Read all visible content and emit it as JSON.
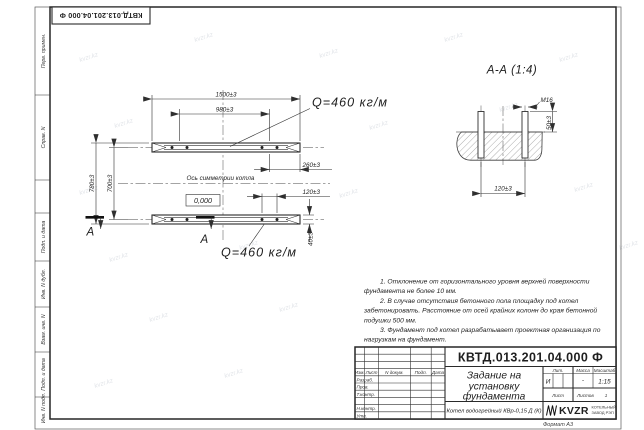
{
  "sheet": {
    "doc_number_top": "КВТД.013.201.04.000 Ф",
    "format_note": "Формат А3",
    "watermark": "kvzr.kz",
    "margin_labels": {
      "perv": "Перв. примен.",
      "sprav": "Справ. N",
      "podp1": "Подп. и дата",
      "inv_dubl": "Инв. N дубл.",
      "vzam": "Взам. инв. N",
      "podp2": "Подп. и дата",
      "inv_podl": "Инв. N подл."
    }
  },
  "plan": {
    "dim_1500": "1500±3",
    "dim_980": "980±3",
    "dim_780": "780±3",
    "dim_700": "700±3",
    "dim_260": "260±3",
    "dim_120": "120±3",
    "dim_40": "40±3",
    "level": "0,000",
    "axis_label": "Ось симметрии котла",
    "load_top": "Q=460 кг/м",
    "load_bottom": "Q=460 кг/м",
    "section_letter_left": "А",
    "section_letter_right": "А"
  },
  "section": {
    "title": "А-А (1:4)",
    "thread": "М16",
    "dim_50": "50±3",
    "dim_120": "120±3"
  },
  "notes": {
    "l1": "1. Отклонение от горизонтального уровня верхней поверхности",
    "l2": "фундамента не более 10 мм.",
    "l3": "2. В случае отсутствия бетонного пола площадку под котел",
    "l4": "забетонировать. Расстояние от осей крайних колонн до края бетонной",
    "l5": "подушки 500 мм.",
    "l6": "3. Фундамент под котел разрабатывает проектная организация по",
    "l7": "нагрузкам на фундамент."
  },
  "titleblock": {
    "doc_number": "КВТД.013.201.04.000 Ф",
    "title_l1": "Задание на",
    "title_l2": "установку",
    "title_l3": "фундамента",
    "product": "Котел водогрейный КВр-0,15 Д (К)",
    "h_lit": "Лит.",
    "h_mass": "Масса",
    "h_scale": "Масштаб",
    "v_lit": "И",
    "v_mass": "-",
    "v_scale": "1:15",
    "h_sheet": "Лист",
    "h_sheets": "Листов",
    "v_sheets": "1",
    "c_izm": "Изм.",
    "c_list": "Лист",
    "c_ndoc": "N докум.",
    "c_podp": "Подп.",
    "c_data": "Дата",
    "r_razrab": "Разраб.",
    "r_prov": "Пров.",
    "r_tkontr": "Т.контр.",
    "r_nkontr": "Н.контр.",
    "r_utv": "Утв.",
    "logo": "KVZR",
    "company_l1": "КОТЕЛЬНЫЙ",
    "company_l2": "ЗАВОД РЭП"
  }
}
